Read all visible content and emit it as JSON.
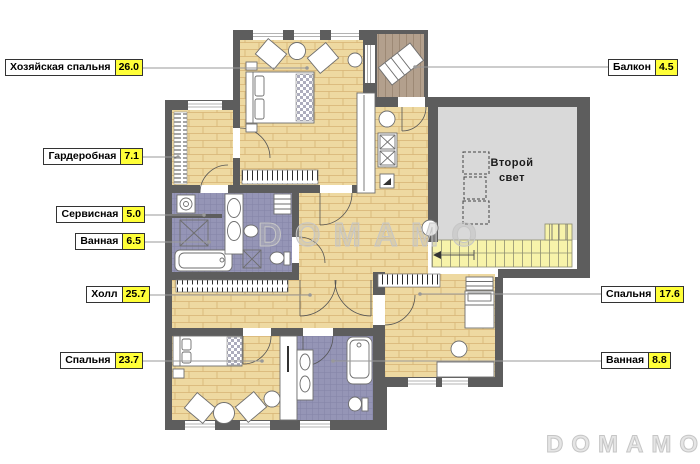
{
  "watermarks": {
    "center": "DOMAMO",
    "corner": "DOMAMO"
  },
  "second_light": {
    "line1": "Второй",
    "line2": "свет"
  },
  "labels": [
    {
      "name": "Хозяйская спальня",
      "area": "26.0"
    },
    {
      "name": "Балкон",
      "area": "4.5"
    },
    {
      "name": "Гардеробная",
      "area": "7.1"
    },
    {
      "name": "Сервисная",
      "area": "5.0"
    },
    {
      "name": "Ванная",
      "area": "6.5"
    },
    {
      "name": "Холл",
      "area": "25.7"
    },
    {
      "name": "Спальня",
      "area": "23.7"
    },
    {
      "name": "Спальня",
      "area": "17.6"
    },
    {
      "name": "Ванная",
      "area": "8.8"
    }
  ],
  "colors": {
    "wall": "#5d5d5d",
    "wood": "#eed9a1",
    "wood_line": "#c59a55",
    "tile": "#9595b6",
    "tile_line": "#8686a9",
    "second_light_gray": "#d9d9d9",
    "stairs": "#f7f3aa",
    "stairs_line": "#8f8f72",
    "deck": "#b3a08d",
    "deck_line": "#9b8672",
    "label_accent": "#ffff38",
    "leader": "#999999",
    "fixture_line": "#6e6e6e",
    "watermark": "#c6c6c6"
  }
}
